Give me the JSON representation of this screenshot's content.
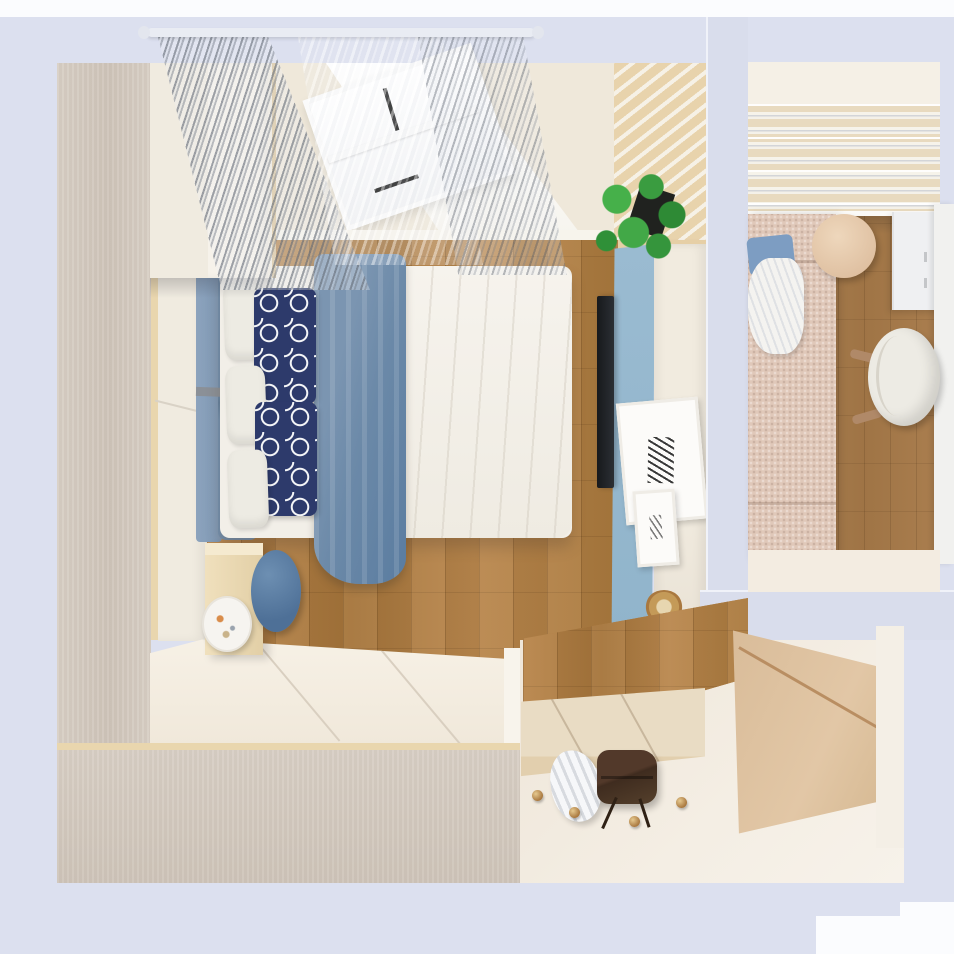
{
  "palette": {
    "lavenderWall": "#dce0ef",
    "lavenderWall2": "#d9ddec",
    "topBand": "#fbfcfe",
    "wardrobeTop": "#d8cfc5",
    "wardrobeTopDark": "#cfc5ba",
    "doorPanel": "#f0ebe0",
    "woodEdge": "#e9d6ae",
    "wallCream": "#efe8da",
    "ceilingWhite": "#f6f4ee",
    "slatWood": "#e8d3ac",
    "floorWood": "#b28148",
    "floorWoodDark": "#a5743a",
    "adjFloorWood": "#a87c4e",
    "platformCream": "#f0e8da",
    "stepBeige": "#e9dcc4",
    "stepFace": "#e2cfae",
    "hallFloor": "#f4eee4",
    "headboardBlue": "#7f98b4",
    "blanketBlue": "#6b89a8",
    "blanketBlueDark": "#5a7ca0",
    "duvetWhite": "#f2efe8",
    "pillowWhite": "#edebe3",
    "navy": "#2d3a6b",
    "accentBlue": "#8fb3ca",
    "consoleCream": "#f1ebdf",
    "tvBlack": "#2b2f34",
    "frameWhite": "#fcfbf9",
    "plantGreen": "#42a847",
    "plantGreenDark": "#2f9038",
    "potBlack": "#20221f",
    "gold": "#a9783f",
    "nightstandWood": "#e2cfa6",
    "poufBlue": "#4e7097",
    "sofaBeige": "#e0c8b9",
    "sofaPillowBlue": "#7d9dc2",
    "tableBeige": "#dfc0a1",
    "cabinetWhite": "#eff0f2",
    "chairWhite": "#edebe4",
    "woodLeg": "#b08968",
    "stripeBeige": "#e8dabf",
    "tanWardrobe": "#e2c7a6",
    "tanSeam": "#b98e62",
    "bagBrown": "#3f2c1f",
    "towelWhite": "#f3f4f6"
  },
  "objects": {
    "scene": {
      "label": "top-down 3d render of a small bedroom with adjacent study room and hallway"
    },
    "wardrobe_left": {
      "label": "tall wardrobe along left wall, view of top"
    },
    "closet_doors": {
      "label": "cream wardrobe door fronts"
    },
    "shelf_unit": {
      "label": "shelf cabinet above headboard"
    },
    "wall_window": {
      "label": "window wall with sheer curtains"
    },
    "window": {
      "label": "white double-pane window with dark handles"
    },
    "curtain_rod": {
      "label": "white curtain rod"
    },
    "curtain_gray": {
      "label": "gray sheer curtain"
    },
    "curtain_sheer": {
      "label": "white sheer curtain"
    },
    "ceiling": {
      "label": "white ceiling soffit"
    },
    "slat_panel": {
      "label": "wood slat feature panel"
    },
    "floor_bedroom": {
      "label": "oak plank bedroom floor"
    },
    "bed": {
      "label": "double bed"
    },
    "headboard": {
      "label": "blue upholstered headboard"
    },
    "pillow_white": {
      "label": "white pillow"
    },
    "pillow_navy": {
      "label": "navy trellis-pattern pillow"
    },
    "blanket": {
      "label": "steel-blue throw blanket draped across bed"
    },
    "duvet": {
      "label": "white duvet"
    },
    "nightstand": {
      "label": "light wood nightstand"
    },
    "plate": {
      "label": "decorative plate with flowers"
    },
    "pouf": {
      "label": "round blue pouf"
    },
    "platform": {
      "label": "raised white platform floor"
    },
    "wardrobe_bottom": {
      "label": "low cabinet run along bottom-left, view of top"
    },
    "accent_wall": {
      "label": "light blue tv accent panel"
    },
    "tv": {
      "label": "wall-mounted television seen edge-on"
    },
    "console": {
      "label": "white media console"
    },
    "frame_big": {
      "label": "large white picture frame with botanical print"
    },
    "frame_small": {
      "label": "small white picture frame"
    },
    "gold_dish": {
      "label": "round gold trinket dish"
    },
    "plant": {
      "label": "green potted plant"
    },
    "wall_right": {
      "label": "partition wall between rooms"
    },
    "adj_blinds": {
      "label": "striped blinds / ceiling slats of adjacent room"
    },
    "adj_floor": {
      "label": "wood floor of adjacent room"
    },
    "sofa": {
      "label": "beige daybed with blue cushion and white bedding"
    },
    "side_table": {
      "label": "round beige side table"
    },
    "adj_cabinet": {
      "label": "white storage cabinet"
    },
    "adj_desk": {
      "label": "white desk along right wall"
    },
    "chair": {
      "label": "white desk chair with wooden legs"
    },
    "hall_floor": {
      "label": "cream hallway floor"
    },
    "step": {
      "label": "tiled entry step platform"
    },
    "towel": {
      "label": "crumpled white cloth on floor"
    },
    "bag": {
      "label": "brown leather bag with strap"
    },
    "knob": {
      "label": "round brass floor hook"
    },
    "tan_wardrobe": {
      "label": "tan sliding-door wardrobe in hallway"
    }
  }
}
